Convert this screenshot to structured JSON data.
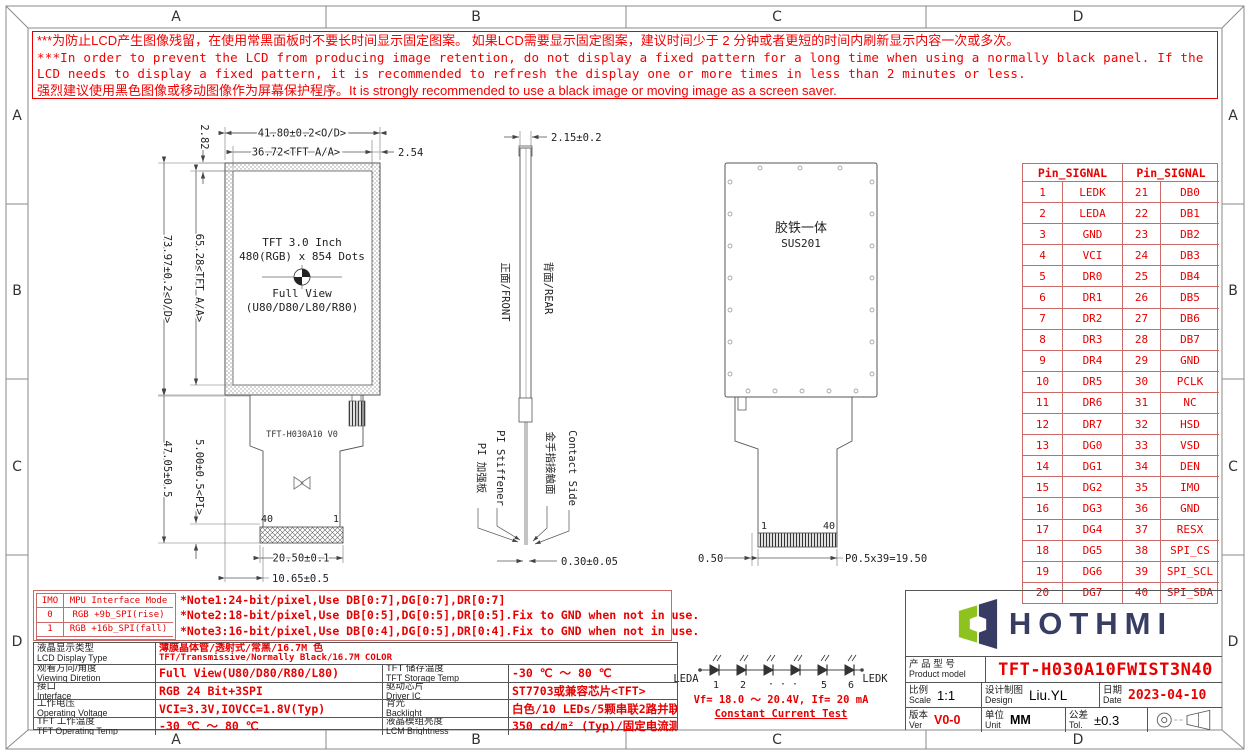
{
  "frame": {
    "zones": [
      "A",
      "B",
      "C",
      "D"
    ]
  },
  "warning": {
    "lines": [
      "***为防止LCD产生图像残留，在使用常黑面板时不要长时间显示固定图案。 如果LCD需要显示固定图案，建议时间少于 2 分钟或者更短的时间内刷新显示内容一次或多次。",
      "***In order to prevent the LCD from producing image retention, do not display a fixed pattern for a long time when using a normally black panel. If the",
      " LCD needs to display a fixed pattern, it is recommended to refresh the display one or more times in less than 2 minutes or less.",
      "强烈建议使用黑色图像或移动图像作为屏幕保护程序。It is strongly recommended to use a black image or moving image as a screen saver."
    ]
  },
  "front_view": {
    "panel_text": {
      "line1": "TFT 3.0 Inch",
      "line2": "480(RGB) x 854 Dots",
      "line3": "Full View",
      "line4": "(U80/D80/L80/R80)"
    },
    "fpc_label": "TFT-H030A10 V0",
    "pin_left": "40",
    "pin_right": "1",
    "dims": {
      "width_od": "41.80±0.2<O/D>",
      "width_aa": "36.72<TFT A/A>",
      "right_margin": "2.54",
      "top_margin": "2.82",
      "height_od": "73.97±0.2<O/D>",
      "height_aa": "65.28<TFT A/A>",
      "fpc_length": "47.05±0.5",
      "pi_length": "5.00±0.5<PI>",
      "connector_width": "20.50±0.1",
      "tail_offset": "10.65±0.5"
    }
  },
  "side_view": {
    "labels": {
      "front": "正面/FRONT",
      "rear": "背面/REAR",
      "pi_cn": "PI 加强板",
      "pi_en": "PI Stiffener",
      "contact_cn": "金手指接触面",
      "contact_en": "Contact Side"
    },
    "dims": {
      "thickness": "2.15±0.2",
      "fpc_thickness": "0.30±0.05"
    }
  },
  "rear_view": {
    "body_cn": "胶铁一体",
    "body_en": "SUS201",
    "pin_left": "1",
    "pin_right": "40",
    "dims": {
      "edge_margin": "0.50",
      "pitch": "P0.5x39=19.50"
    }
  },
  "pin_table": {
    "header": "Pin_SIGNAL",
    "rows": [
      [
        "1",
        "LEDK",
        "21",
        "DB0"
      ],
      [
        "2",
        "LEDA",
        "22",
        "DB1"
      ],
      [
        "3",
        "GND",
        "23",
        "DB2"
      ],
      [
        "4",
        "VCI",
        "24",
        "DB3"
      ],
      [
        "5",
        "DR0",
        "25",
        "DB4"
      ],
      [
        "6",
        "DR1",
        "26",
        "DB5"
      ],
      [
        "7",
        "DR2",
        "27",
        "DB6"
      ],
      [
        "8",
        "DR3",
        "28",
        "DB7"
      ],
      [
        "9",
        "DR4",
        "29",
        "GND"
      ],
      [
        "10",
        "DR5",
        "30",
        "PCLK"
      ],
      [
        "11",
        "DR6",
        "31",
        "NC"
      ],
      [
        "12",
        "DR7",
        "32",
        "HSD"
      ],
      [
        "13",
        "DG0",
        "33",
        "VSD"
      ],
      [
        "14",
        "DG1",
        "34",
        "DEN"
      ],
      [
        "15",
        "DG2",
        "35",
        "IMO"
      ],
      [
        "16",
        "DG3",
        "36",
        "GND"
      ],
      [
        "17",
        "DG4",
        "37",
        "RESX"
      ],
      [
        "18",
        "DG5",
        "38",
        "SPI_CS"
      ],
      [
        "19",
        "DG6",
        "39",
        "SPI_SCL"
      ],
      [
        "20",
        "DG7",
        "40",
        "SPI_SDA"
      ]
    ]
  },
  "notes": {
    "imo_header": [
      "IMO",
      "MPU Interface Mode"
    ],
    "imo_rows": [
      [
        "0",
        "RGB +9b_SPI(rise)"
      ],
      [
        "1",
        "RGB +16b_SPI(fall)"
      ]
    ],
    "lines": [
      "*Note1:24-bit/pixel,Use DB[0:7],DG[0:7],DR[0:7]",
      "*Note2:18-bit/pixel,Use DB[0:5],DG[0:5],DR[0:5].Fix to GND  when not in use.",
      "*Note3:16-bit/pixel,Use DB[0:4],DG[0:5],DR[0:4].Fix to GND  when not in use."
    ]
  },
  "spec_table": {
    "row1": {
      "label_cn": "液晶显示类型",
      "label_en": "LCD Display Type",
      "value_cn": "薄膜晶体管/透射式/常黑/16.7M 色",
      "value_en": "TFT/Transmissive/Normally Black/16.7M COLOR"
    },
    "rows": [
      {
        "label_cn": "观看方向/角度",
        "label_en": "Viewing Diretion",
        "value": "Full View(U80/D80/R80/L80)",
        "label2_cn": "TFT 储存温度",
        "label2_en": "TFT Storage Temp",
        "value2": "-30 ℃ ～ 80 ℃"
      },
      {
        "label_cn": "接口",
        "label_en": "Interface",
        "value": "RGB 24 Bit+3SPI",
        "label2_cn": "驱动芯片",
        "label2_en": "Driver IC",
        "value2": "ST7703或兼容芯片<TFT>"
      },
      {
        "label_cn": "工作电压",
        "label_en": "Operating Voltage",
        "value": "VCI=3.3V,IOVCC=1.8V(Typ)",
        "label2_cn": "背光",
        "label2_en": "Backlight",
        "value2": "白色/10 LEDs/5颗串联2路并联"
      },
      {
        "label_cn": "TFT 工作温度",
        "label_en": "TFT Operating Temp",
        "value": "-30 ℃ ～ 80 ℃",
        "label2_cn": "液晶模组亮度",
        "label2_en": "LCM Brightness",
        "value2": "350 cd/m² (Typ)/固定电流测试"
      }
    ]
  },
  "backlight": {
    "leda": "LEDA",
    "ledk": "LEDK",
    "numbers": [
      "1",
      "2",
      "· · ·",
      "5",
      "6"
    ],
    "vf_line": "Vf= 18.0 ～ 20.4V, If= 20 mA",
    "test_line": "Constant Current Test"
  },
  "title_block": {
    "brand": "HOTHMI",
    "product_label_cn": "产 品 型 号",
    "product_label_en": "Product model",
    "product_model": "TFT-H030A10FWIST3N40",
    "scale_cn": "比例",
    "scale_en": "Scale",
    "scale_val": "1:1",
    "design_cn": "设计制图",
    "design_en": "Design",
    "design_val": "Liu.YL",
    "date_cn": "日期",
    "date_en": "Date",
    "date_val": "2023-04-10",
    "ver_cn": "版本",
    "ver_en": "Ver",
    "ver_val": "V0-0",
    "unit_cn": "单位",
    "unit_en": "Unit",
    "unit_val": "MM",
    "tol_cn": "公差",
    "tol_en": "Tol.",
    "tol_val": "±0.3"
  },
  "colors": {
    "red": "#e80000",
    "table_border_red": "#cc6a6a",
    "line": "#555555",
    "logo_green": "#8dc21f",
    "logo_navy": "#383b63"
  }
}
